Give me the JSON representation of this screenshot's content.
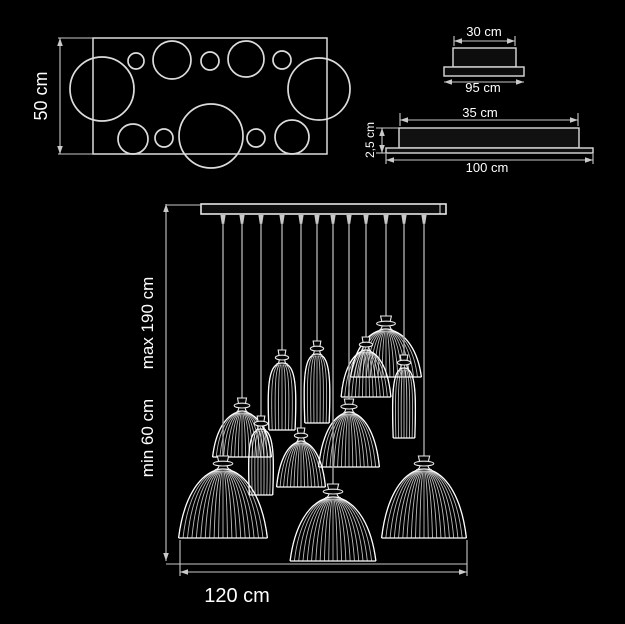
{
  "meta": {
    "background": "#000000",
    "line_color": "#dcdcdc",
    "dim_color": "#c9c9c9",
    "cord_color": "#a8a8a8",
    "text_color": "#ffffff"
  },
  "plan_view": {
    "height_label": "50 cm",
    "rect": {
      "x": 93,
      "y": 38,
      "w": 234,
      "h": 116
    },
    "dim_x": 60,
    "circles": [
      [
        136,
        61,
        8
      ],
      [
        172,
        60,
        19
      ],
      [
        210,
        61,
        9
      ],
      [
        246,
        59,
        18
      ],
      [
        282,
        60,
        9
      ],
      [
        102,
        89,
        32
      ],
      [
        319,
        89,
        31
      ],
      [
        133,
        139,
        15
      ],
      [
        164,
        138,
        9
      ],
      [
        211,
        136,
        32
      ],
      [
        256,
        138,
        9
      ],
      [
        292,
        137,
        17
      ]
    ]
  },
  "canopy_side_view": {
    "top_label": "30 cm",
    "bottom_label": "95 cm",
    "body": {
      "x": 453,
      "y": 48,
      "w": 63,
      "h": 19
    },
    "base": {
      "x": 444,
      "y": 67,
      "w": 80,
      "h": 9
    }
  },
  "canopy_front_view": {
    "top_label": "35 cm",
    "height_label": "2,5 cm",
    "bottom_label": "100 cm",
    "body": {
      "x": 399,
      "y": 128,
      "w": 180,
      "h": 20
    },
    "base": {
      "x": 386,
      "y": 148,
      "w": 207,
      "h": 5
    }
  },
  "fixture": {
    "max_label": "max 190 cm",
    "min_label": "min 60 cm",
    "width_label": "120 cm",
    "bar": {
      "x": 201,
      "y": 204,
      "w": 245,
      "h": 10
    },
    "dim_x": 166,
    "ref_line_y": 564,
    "width_dim": {
      "x1": 180,
      "x2": 467,
      "y": 572
    },
    "shades": [
      {
        "type": "dome",
        "cx": 386,
        "top": 330,
        "w": 72,
        "h": 47,
        "ribs": 19
      },
      {
        "type": "dome",
        "cx": 366,
        "top": 351,
        "w": 51,
        "h": 46,
        "ribs": 15
      },
      {
        "type": "bell",
        "cx": 282,
        "top": 364,
        "w": 29,
        "h": 66,
        "ribs": 9
      },
      {
        "type": "bell",
        "cx": 317,
        "top": 355,
        "w": 27,
        "h": 68,
        "ribs": 9
      },
      {
        "type": "bell",
        "cx": 404,
        "top": 369,
        "w": 24,
        "h": 69,
        "ribs": 9
      },
      {
        "type": "bell",
        "cx": 261,
        "top": 430,
        "w": 26,
        "h": 65,
        "ribs": 9
      },
      {
        "type": "dome",
        "cx": 242,
        "top": 412,
        "w": 60,
        "h": 45,
        "ribs": 17
      },
      {
        "type": "dome",
        "cx": 349,
        "top": 413,
        "w": 62,
        "h": 54,
        "ribs": 17
      },
      {
        "type": "dome",
        "cx": 301,
        "top": 442,
        "w": 50,
        "h": 45,
        "ribs": 15
      },
      {
        "type": "dome",
        "cx": 223,
        "top": 470,
        "w": 90,
        "h": 68,
        "ribs": 21
      },
      {
        "type": "dome",
        "cx": 424,
        "top": 470,
        "w": 86,
        "h": 68,
        "ribs": 21
      },
      {
        "type": "dome",
        "cx": 333,
        "top": 498,
        "w": 87,
        "h": 63,
        "ribs": 21
      }
    ]
  }
}
